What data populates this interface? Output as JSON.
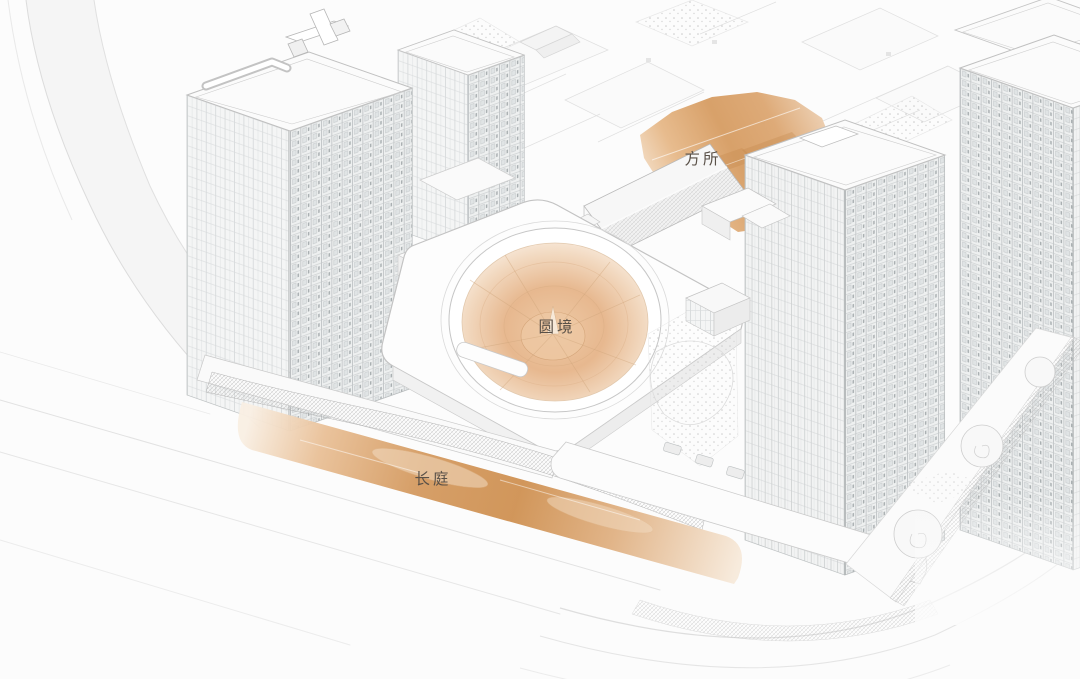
{
  "scene": {
    "kind": "residential-complex-axonometric-rendering",
    "background": "#fcfcfc"
  },
  "labels": {
    "fangsuo": "方所",
    "yuanjing": "圆境",
    "changting": "长庭"
  },
  "colors": {
    "highlight_deep": "#cf9152",
    "highlight_mid": "#dca674",
    "highlight_light": "#f2dcc6",
    "funnel_center": "#e7b88f",
    "linework": "#c4c4c4",
    "linework_faint": "#e0e0e0",
    "face_shade": "#eef0f0",
    "label_text": "#5a5148"
  }
}
